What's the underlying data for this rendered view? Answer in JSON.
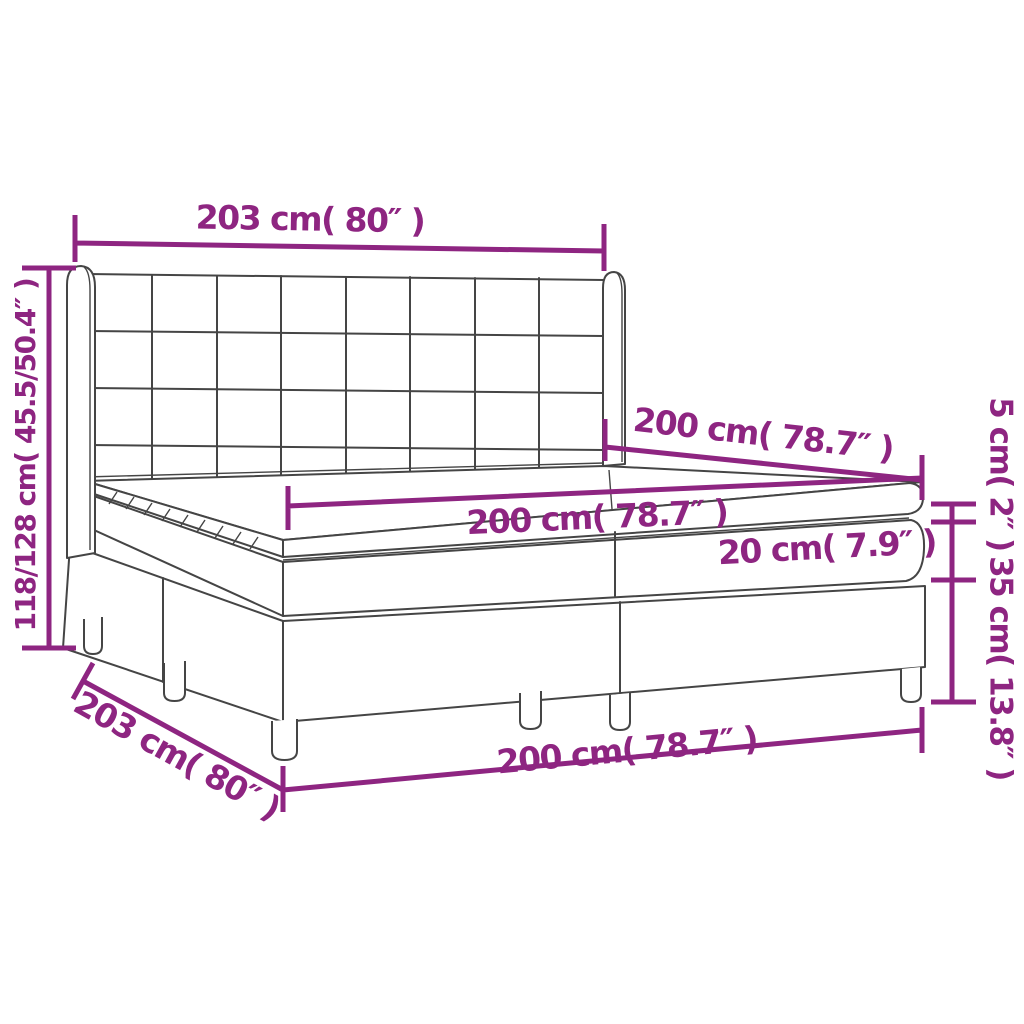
{
  "diagram": {
    "accent_color": "#8e2581",
    "line_color": "#454545",
    "background": "#ffffff",
    "labels": {
      "headboard_width": "203 cm( 80″ )",
      "overall_height": "118/128 cm( 45.5/50.4″ )",
      "bed_length": "200 cm( 78.7″ )",
      "mattress_width": "200 cm( 78.7″ )",
      "mattress_thickness": "20 cm( 7.9″ )",
      "topper_thickness": "5 cm( 2″ )",
      "base_height": "35 cm( 13.8″ )",
      "base_width": "203 cm( 80″ )",
      "base_length": "200 cm( 78.7″ )"
    }
  }
}
